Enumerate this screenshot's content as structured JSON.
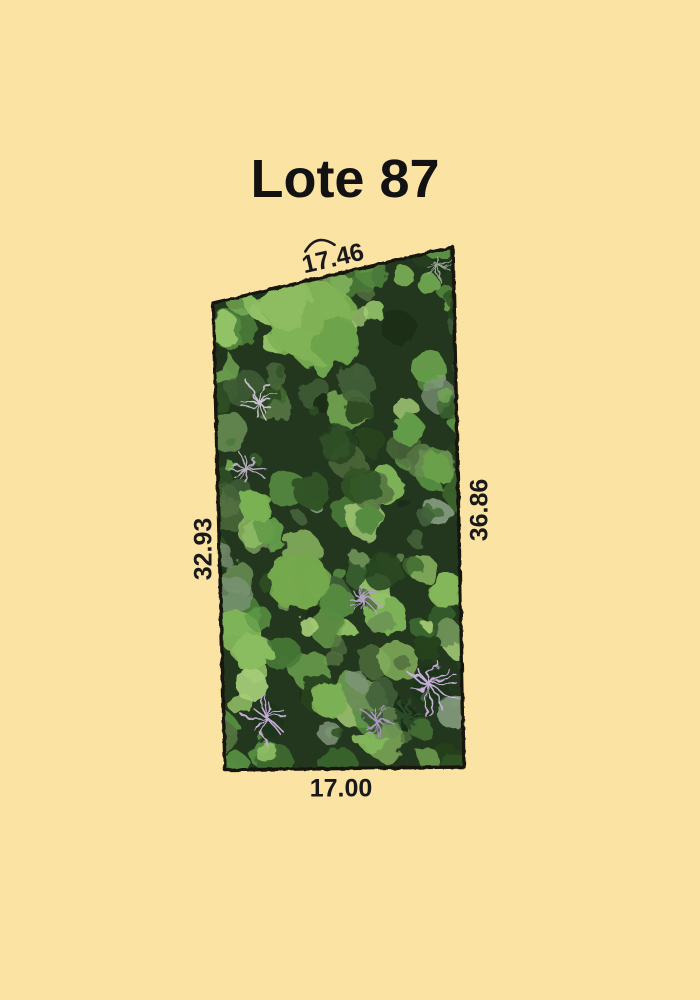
{
  "page": {
    "background_color": "#fbe3a3"
  },
  "title": {
    "text": "Lote 87"
  },
  "lot": {
    "name": "Lote 87",
    "border_color": "#17130d",
    "measurements": {
      "top": "17.46",
      "right": "36.86",
      "left": "32.93",
      "bottom": "17.00"
    }
  }
}
